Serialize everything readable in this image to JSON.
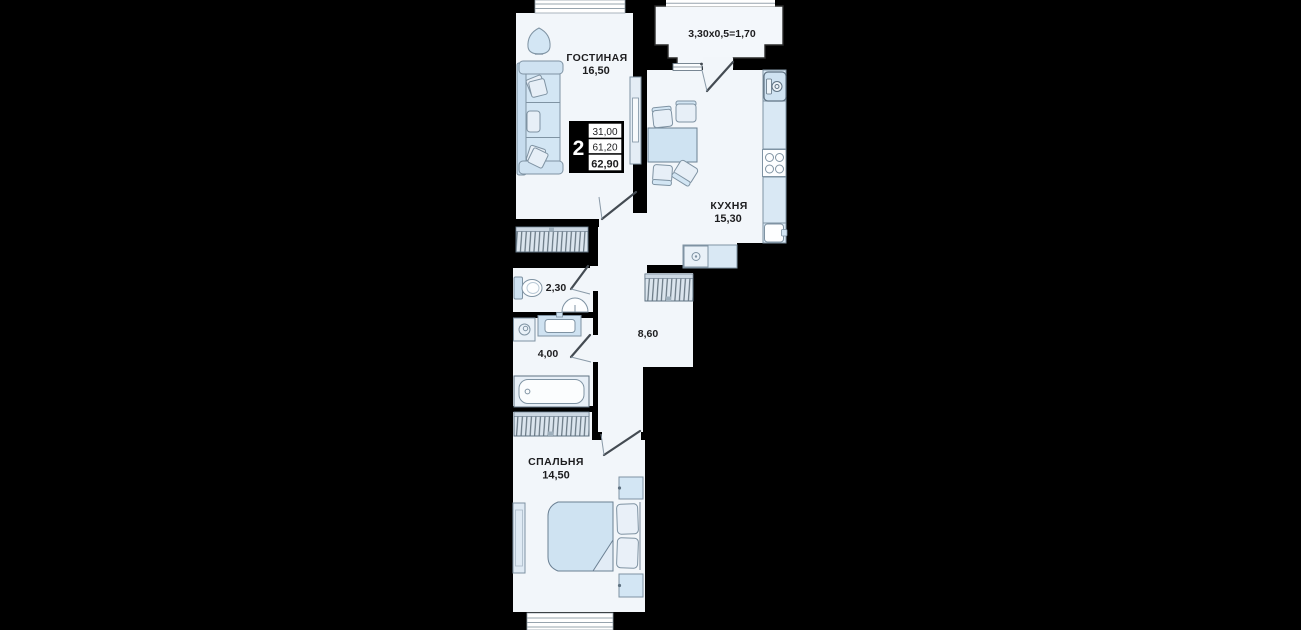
{
  "canvas": {
    "width": 1301,
    "height": 630,
    "background": "#000000"
  },
  "apartment": {
    "badge": {
      "rooms_count": "2",
      "living_area": "31,00",
      "area_without_balcony": "61,20",
      "total_area": "62,90"
    },
    "rooms": {
      "living": {
        "name": "ГОСТИНАЯ",
        "area": "16,50"
      },
      "kitchen": {
        "name": "КУХНЯ",
        "area": "15,30"
      },
      "bedroom": {
        "name": "СПАЛЬНЯ",
        "area": "14,50"
      },
      "wc": {
        "area": "2,30"
      },
      "bathroom": {
        "area": "4,00"
      },
      "hall": {
        "area": "8,60"
      },
      "balcony": {
        "label": "3,30x0,5=1,70"
      }
    },
    "colors": {
      "wall": "#000000",
      "floor": "#f2f6fa",
      "furniture": "#d3e6f4",
      "outline": "#7f93a3",
      "hatch": "#5a6a76",
      "text": "#1d1d1f"
    }
  }
}
